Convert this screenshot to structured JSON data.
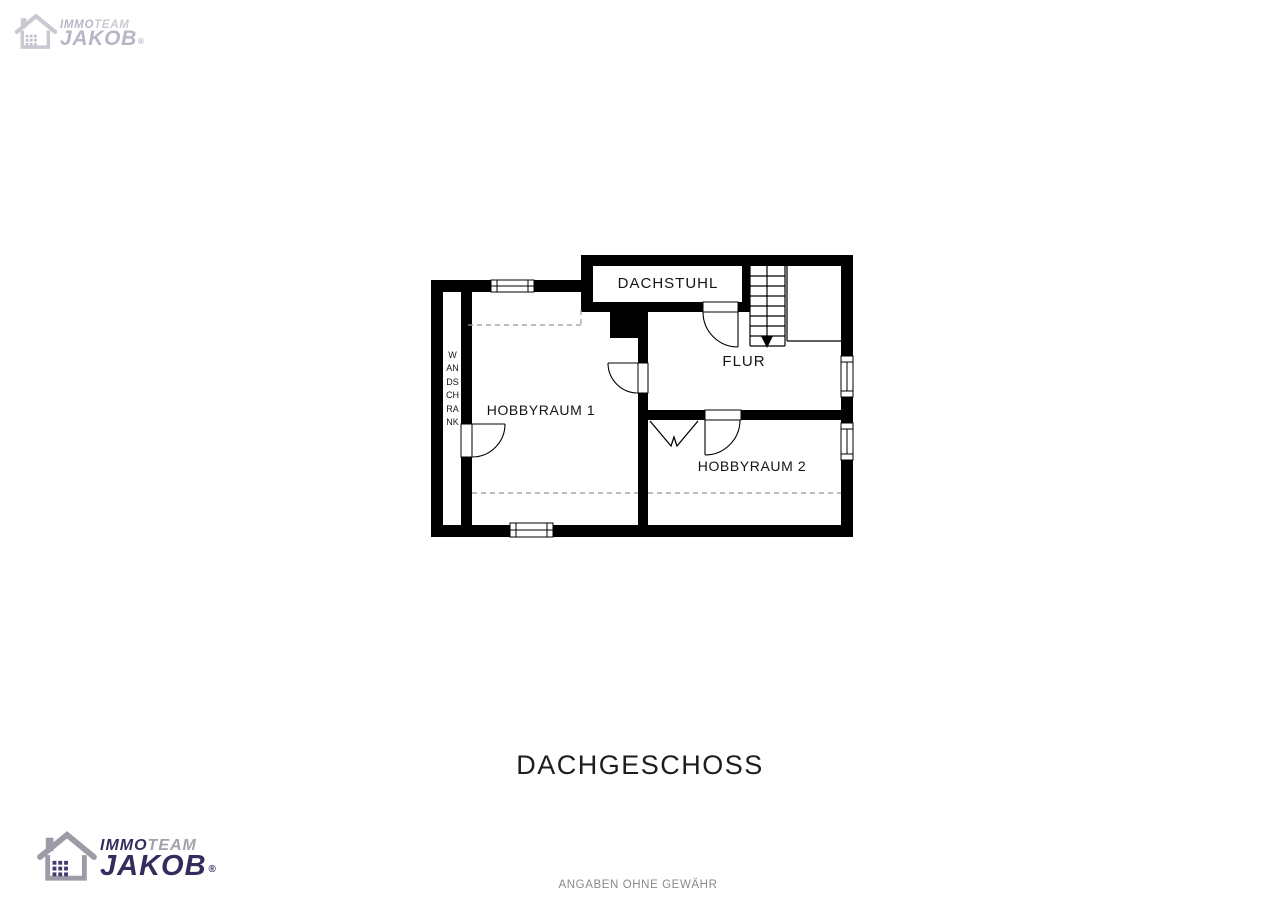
{
  "branding": {
    "immo": "IMMO",
    "team": "TEAM",
    "jakob": "JAKOB",
    "registered": "®",
    "brand_dark": "#332c5c",
    "brand_gray": "#a2a2ac",
    "faded_dark": "#b9b5c6",
    "faded_gray": "#cacad2"
  },
  "floor_plan": {
    "rooms": [
      {
        "label": "DACHSTUHL"
      },
      {
        "label": "FLUR"
      },
      {
        "label": "HOBBYRAUM 1"
      },
      {
        "label": "HOBBYRAUM 2"
      },
      {
        "label": "WANDSCHRANK"
      }
    ],
    "stairs_direction": "down",
    "wall_color": "#000000",
    "dashed_line_color": "#999999"
  },
  "title": "DACHGESCHOSS",
  "footer": "ANGABEN OHNE GEWÄHR"
}
